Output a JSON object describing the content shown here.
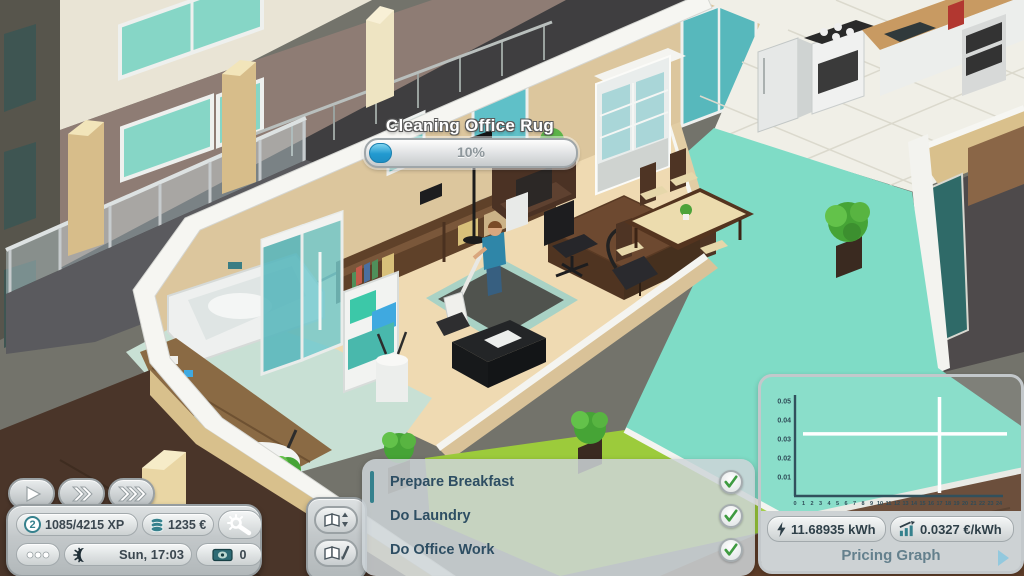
{
  "progress": {
    "title": "Cleaning Office Rug",
    "percent": 11,
    "percent_label": "10%"
  },
  "hud": {
    "level": "2",
    "xp": "1085/4215 XP",
    "money": "1235 €",
    "time": "Sun, 17:03",
    "rent_counter": "0",
    "icons": {
      "speed": [
        "play-icon",
        "fast-forward-icon",
        "fastest-forward-icon"
      ],
      "level_badge": "circled-level-number",
      "money": "coin-stack",
      "settings": "wrench-gear",
      "more": "ellipsis-dots",
      "time": "sun-moon",
      "rent": "banknote"
    }
  },
  "tasks": {
    "items": [
      {
        "label": "Prepare Breakfast",
        "done": true
      },
      {
        "label": "Do Laundry",
        "done": true
      },
      {
        "label": "Do Office Work",
        "done": true
      }
    ],
    "buttons": {
      "reorder": "book-sort-arrows",
      "edit": "book-pencil"
    },
    "done_icon": "green-check"
  },
  "pricing": {
    "energy_value": "11.68935 kWh",
    "rate_value": "0.0327 €/kWh",
    "title": "Pricing Graph",
    "icons": {
      "energy": "lightning-bolt",
      "rate": "trend-chart",
      "expand": "triangle-right"
    }
  },
  "chart_data": {
    "type": "line",
    "title": "Pricing Graph",
    "xlabel": "hour of day",
    "ylabel": "€/kWh",
    "x_axis": {
      "min": 0,
      "max": 24,
      "step": 1
    },
    "y_axis": {
      "ticks": [
        0.01,
        0.02,
        0.03,
        0.04,
        0.05
      ]
    },
    "series": [],
    "crosshair": {
      "x": 17,
      "y": 0.0327
    },
    "current_consumption_kwh": 11.68935,
    "current_price_eur_per_kwh": 0.0327,
    "legend": "none",
    "grid": false
  }
}
